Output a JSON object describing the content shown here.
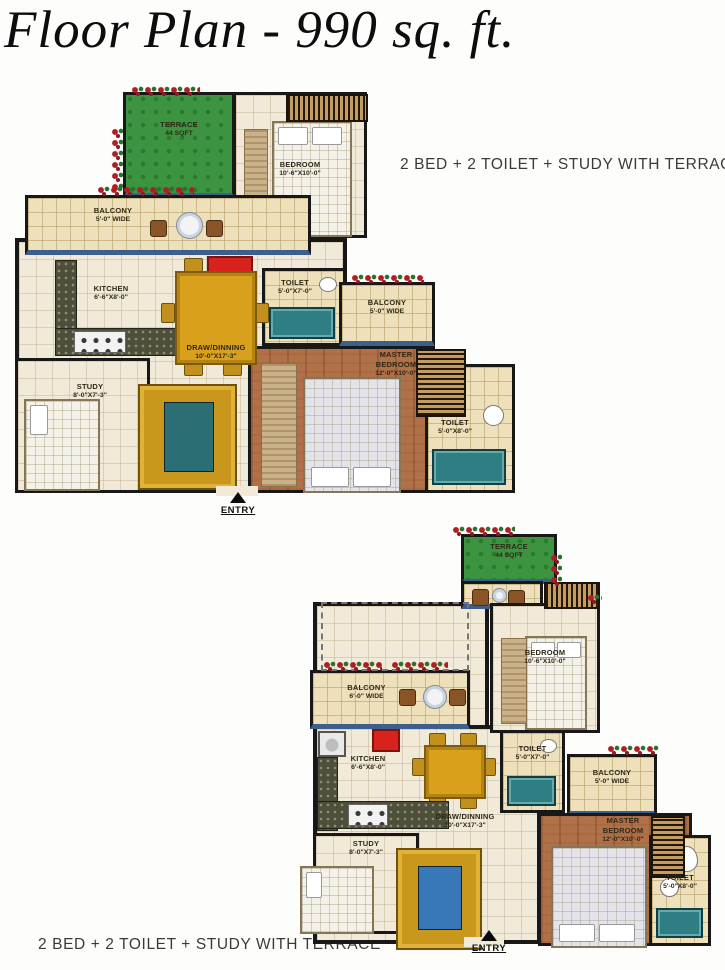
{
  "title": "Floor Plan - 990 sq. ft.",
  "captions": {
    "top": "2 BED + 2 TOILET + STUDY WITH TERRACE",
    "bottom": "2 BED + 2 TOILET + STUDY WITH TERRACE"
  },
  "colors": {
    "wall": "#181818",
    "terrace_green": "#3d9440",
    "master_wood": "#b17148",
    "balcony_blue": "#3c5f8e",
    "tub_teal": "#2e7e84",
    "accent_red": "#d8231d",
    "furniture_gold": "#d8a01d"
  },
  "plans": [
    {
      "name": "upper floor plan",
      "entry_label": "ENTRY",
      "rooms": {
        "terrace": {
          "name": "TERRACE",
          "dims": "44 SQFT"
        },
        "bedroom": {
          "name": "BEDROOM",
          "dims": "10'-6\"X10'-0\""
        },
        "balcony": {
          "name": "BALCONY",
          "dims": "5'-0\" WIDE"
        },
        "kitchen": {
          "name": "KITCHEN",
          "dims": "6'-6\"X8'-0\""
        },
        "draw_dining": {
          "name": "DRAW/DINNING",
          "dims": "10'-0\"X17'-3\""
        },
        "toilet": {
          "name": "TOILET",
          "dims": "5'-0\"X7'-0\""
        },
        "balcony_right": {
          "name": "BALCONY",
          "dims": "5'-0\" WIDE"
        },
        "master_bedroom": {
          "name": "MASTER BEDROOM",
          "dims": "12'-0\"X10'-0\""
        },
        "toilet_right": {
          "name": "TOILET",
          "dims": "5'-0\"X8'-0\""
        },
        "study": {
          "name": "STUDY",
          "dims": "8'-0\"X7'-3\""
        }
      }
    },
    {
      "name": "lower floor plan",
      "entry_label": "ENTRY",
      "rooms": {
        "terrace": {
          "name": "TERRACE",
          "dims": "44 SQFT"
        },
        "bedroom": {
          "name": "BEDROOM",
          "dims": "10'-6\"X10'-0\""
        },
        "balcony": {
          "name": "BALCONY",
          "dims": "6'-0\" WIDE"
        },
        "kitchen": {
          "name": "KITCHEN",
          "dims": "6'-6\"X8'-0\""
        },
        "draw_dining": {
          "name": "DRAW/DINNING",
          "dims": "10'-0\"X17'-3\""
        },
        "toilet": {
          "name": "TOILET",
          "dims": "5'-0\"X7'-0\""
        },
        "balcony_right": {
          "name": "BALCONY",
          "dims": "5'-0\" WIDE"
        },
        "master_bedroom": {
          "name": "MASTER BEDROOM",
          "dims": "12'-0\"X10'-0\""
        },
        "toilet_right": {
          "name": "TOILET",
          "dims": "5'-0\"X8'-0\""
        },
        "study": {
          "name": "STUDY",
          "dims": "8'-0\"X7'-3\""
        }
      }
    }
  ]
}
